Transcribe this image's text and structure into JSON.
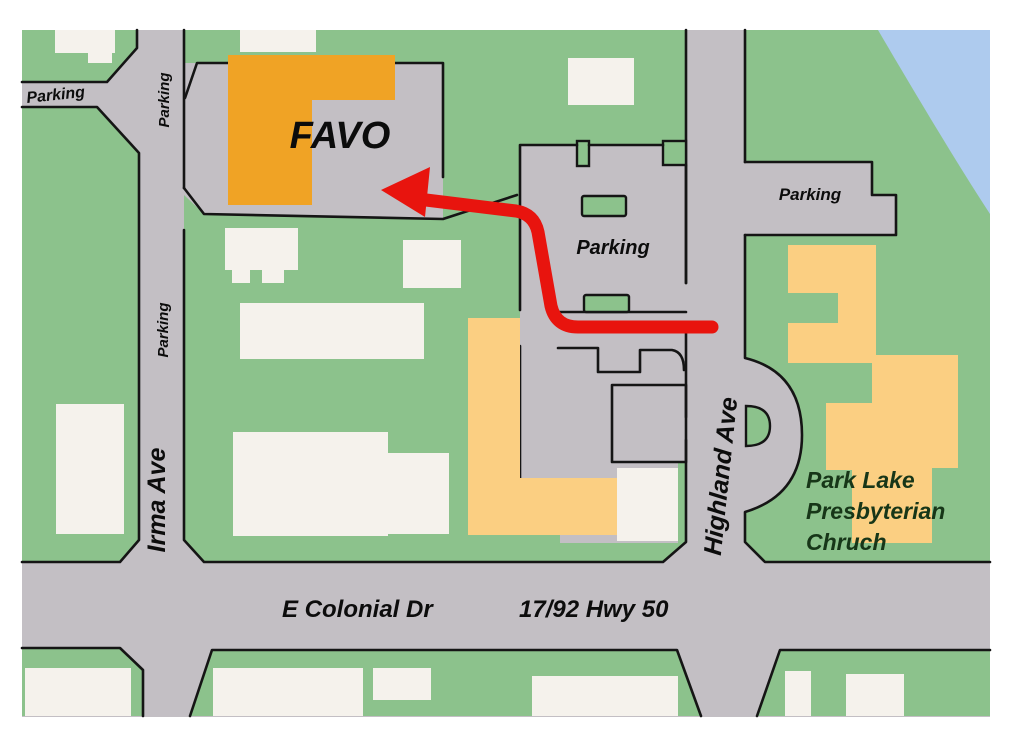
{
  "map": {
    "description": "Street map with route to FAVO",
    "favo_label": "FAVO",
    "labels": {
      "parking_stub": "Parking",
      "parking_road_top": "Parking",
      "parking_road_mid": "Parking",
      "parking_central": "Parking",
      "parking_right": "Parking",
      "irma_ave": "Irma Ave",
      "highland_ave": "Highland Ave",
      "e_colonial": "E Colonial Dr",
      "highway": "17/92  Hwy 50",
      "church_line1": "Park Lake",
      "church_line2": "Presbyterian",
      "church_line3": "Chruch"
    },
    "colors": {
      "land": "#8cc28c",
      "road": "#c3bfc4",
      "building-light": "#f5f2ec",
      "building-orange": "#f0a325",
      "building-tan": "#fbcf82",
      "water": "#aecbee",
      "route-red": "#e8140e",
      "outline": "#151515",
      "ink": "#0c0c0c",
      "church-ink": "#173618"
    }
  }
}
